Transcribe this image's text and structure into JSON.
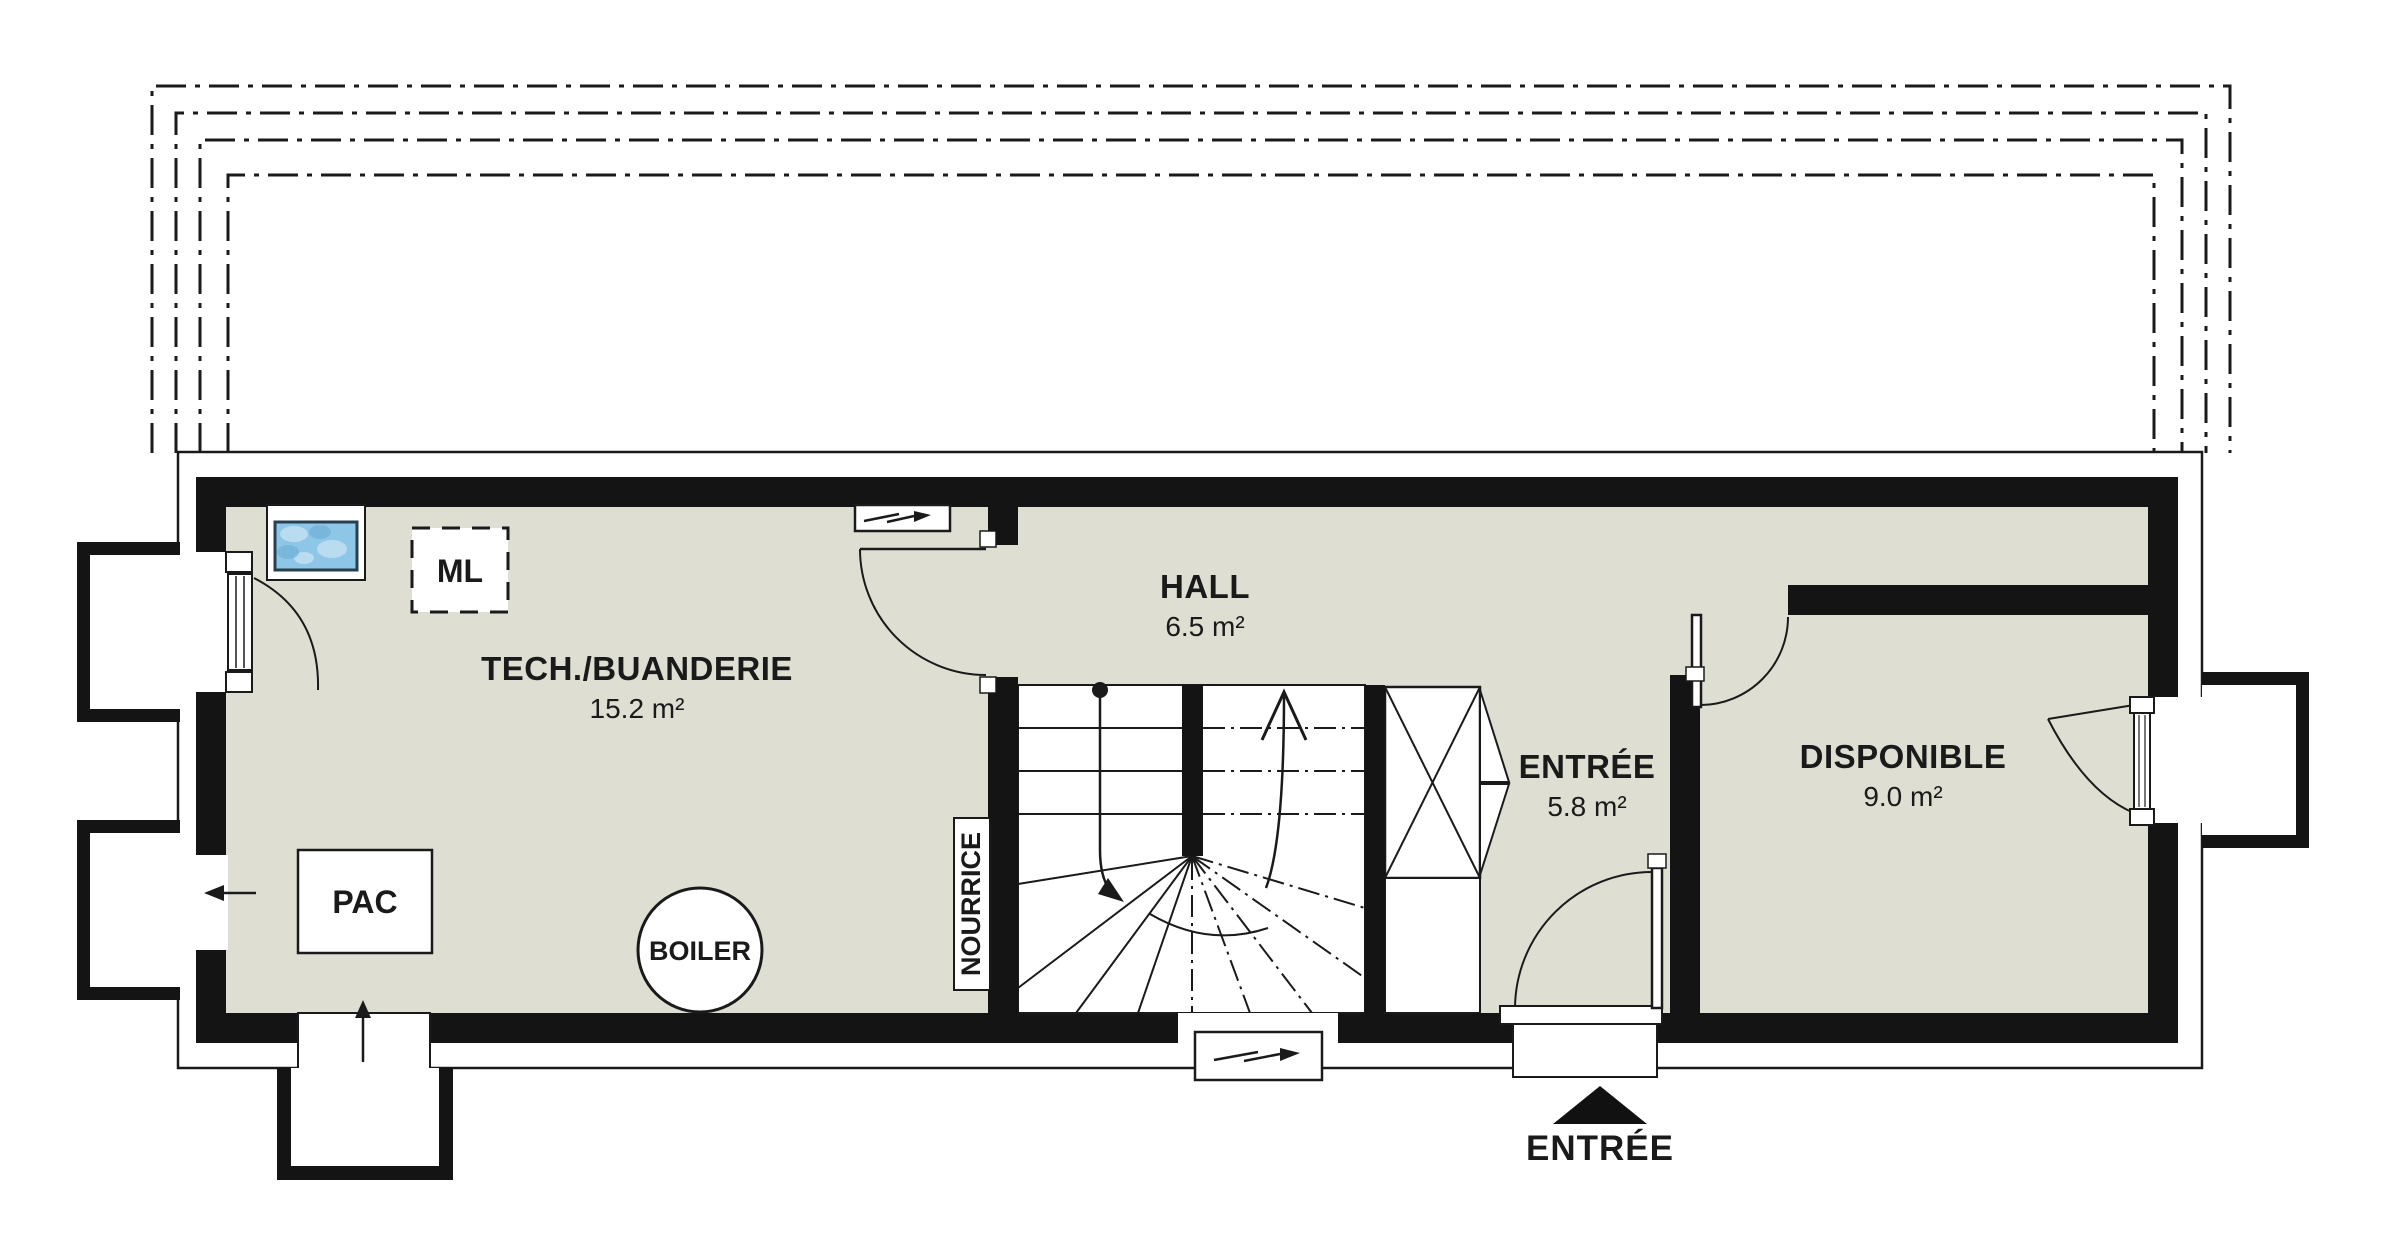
{
  "plan": {
    "rooms": {
      "tech": {
        "name": "TECH./BUANDERIE",
        "area": "15.2 m²"
      },
      "hall": {
        "name": "HALL",
        "area": "6.5 m²"
      },
      "entree": {
        "name": "ENTRÉE",
        "area": "5.8 m²"
      },
      "disponible": {
        "name": "DISPONIBLE",
        "area": "9.0 m²"
      }
    },
    "equipment": {
      "washing_machine": "ML",
      "heat_pump": "PAC",
      "boiler": "BOILER",
      "manifold": "NOURRICE"
    },
    "entrance": {
      "label": "ENTRÉE"
    },
    "colors": {
      "floor": "#dedfd2",
      "wall": "#141414",
      "line": "#1a1a1a",
      "water_fill": "#8ec6e8",
      "water_highlight": "#c2e0f2",
      "water_border": "#27404f"
    }
  }
}
